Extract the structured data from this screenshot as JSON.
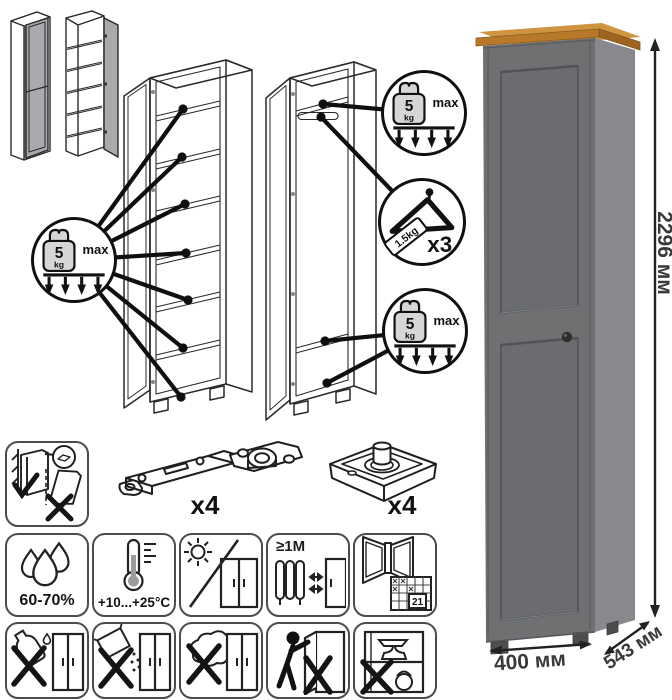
{
  "load_limit": {
    "value": "5",
    "unit": "kg",
    "max_label": "max"
  },
  "hanger_limit": {
    "tag_label": "1.5kg",
    "count_label": "x3"
  },
  "hardware": {
    "hinge_count_label": "x4",
    "foot_count_label": "x4"
  },
  "dimensions": {
    "height_label": "2296 мм",
    "width_label": "400 мм",
    "depth_label": "543 мм"
  },
  "care": {
    "humidity_label": "60-70%",
    "temperature_label": "+10...+25°C",
    "distance_label": "≥1М",
    "calendar_day_label": "21"
  },
  "colors": {
    "line": "#1c1c1c",
    "door_gray": "#a8aaad",
    "wardrobe_front": "#6e7072",
    "wardrobe_side": "#87898c",
    "oak_top": "#bd7e2d",
    "panel_border": "#4c4c4c"
  }
}
